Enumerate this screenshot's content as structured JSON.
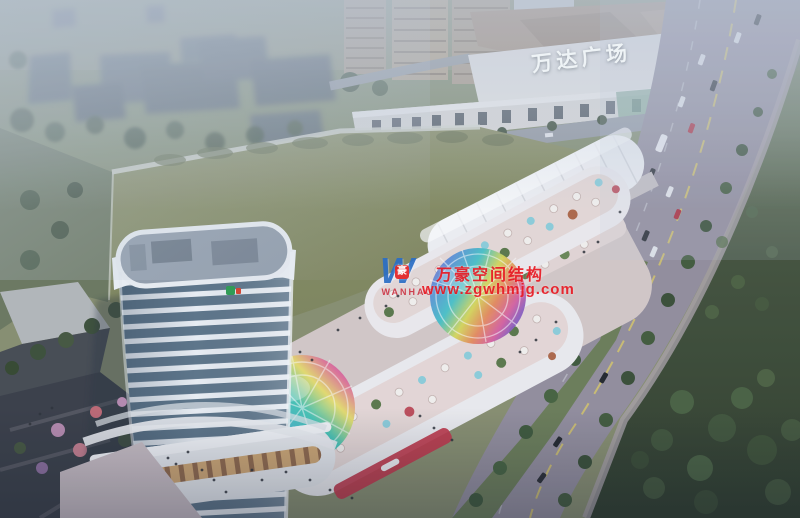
{
  "meta": {
    "title": "Aerial dusk rendering of a mixed-use commercial plaza beside Wanda Plaza",
    "scene_type": "architectural-rendering"
  },
  "signs": {
    "wanda_plaza_label": "万达广场"
  },
  "watermark": {
    "logo_letter": "W",
    "logo_badge_char": "豪",
    "logo_caption": "WANHAO",
    "line1": "万豪空间结构",
    "line2": "www.zgwhmjg.com"
  },
  "palette": {
    "watermark_red": "#e81a24",
    "logo_blue": "#2b6ec6",
    "lawn_olive": "#8f9165",
    "haze_blue": "#c3cedd",
    "tower_glass": "#5e7689",
    "tower_white": "#eef3f7",
    "park_green": "#33412e",
    "road_grey": "#9691a0",
    "mall_white": "#f0eef0",
    "dome_rainbow": [
      "#b06ec8",
      "#5e8fd8",
      "#45c2c8",
      "#d9d957",
      "#e88a5a",
      "#d85f9f"
    ]
  }
}
